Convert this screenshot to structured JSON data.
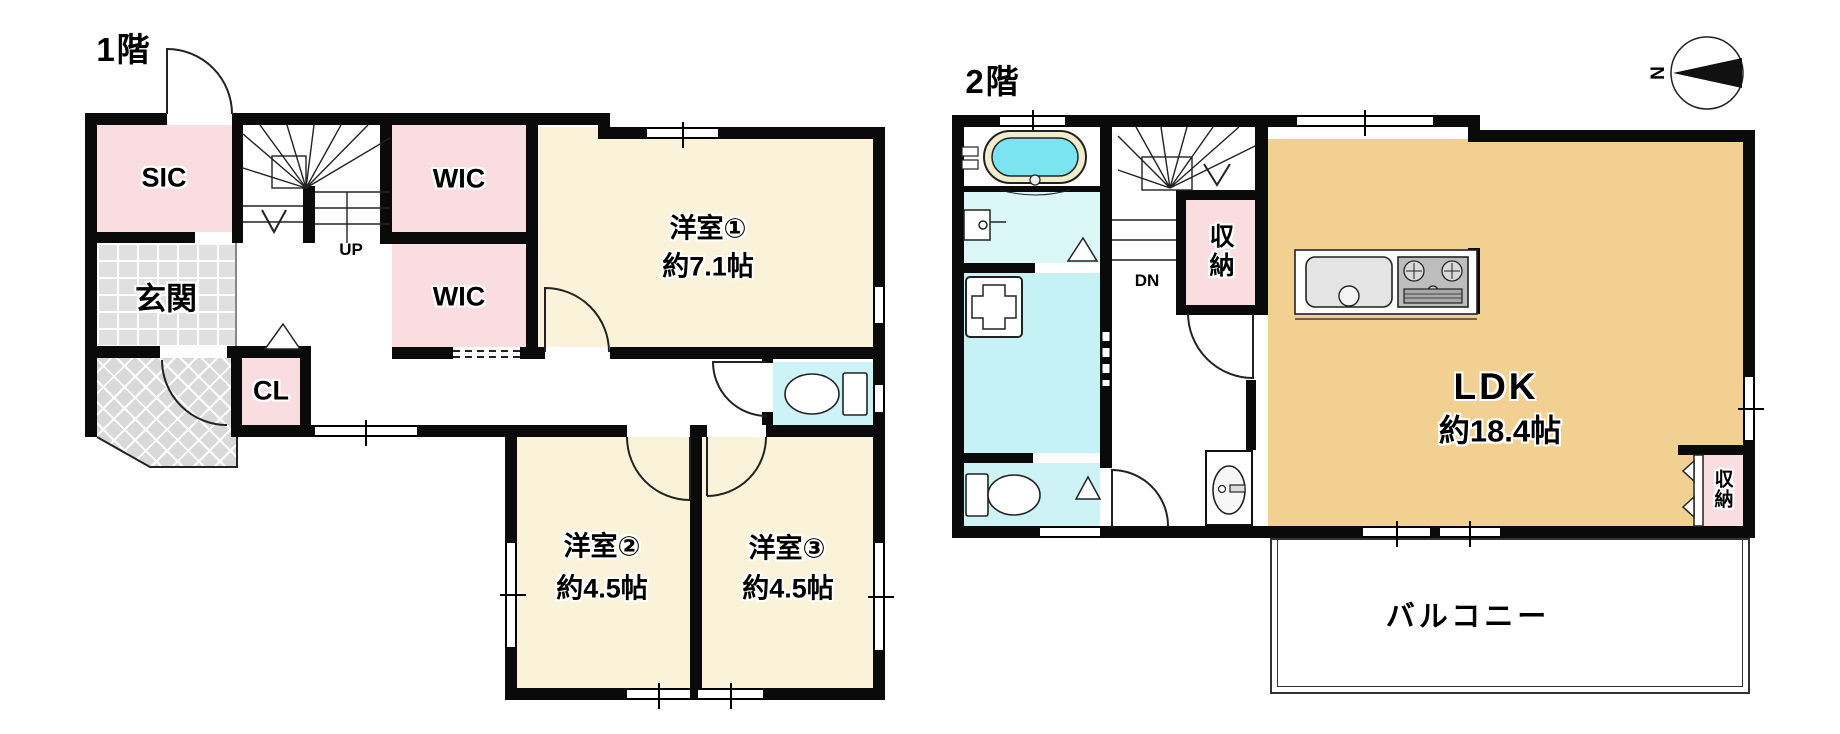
{
  "floor1": {
    "title": "1階",
    "stairs": {
      "label": "UP"
    },
    "rooms": {
      "sic": "SIC",
      "wic_upper": "WIC",
      "wic_lower": "WIC",
      "genkan": "玄関",
      "closet": "CL",
      "bedroom1_name": "洋室①",
      "bedroom1_size": "約7.1帖",
      "bedroom2_name": "洋室②",
      "bedroom2_size": "約4.5帖",
      "bedroom3_name": "洋室③",
      "bedroom3_size": "約4.5帖"
    }
  },
  "floor2": {
    "title": "2階",
    "stairs": {
      "label": "DN"
    },
    "rooms": {
      "storage_center": "収納",
      "storage_right": "収納",
      "ldk_name": "LDK",
      "ldk_size": "約18.4帖",
      "balcony": "バルコニー"
    }
  },
  "compass": {
    "north": "N"
  },
  "colors": {
    "wall": "#0a0a0a",
    "room_pink": "#fadde0",
    "room_cream": "#faf3d9",
    "room_tan": "#f2d092",
    "tile_gray": "#e0e0e0",
    "porch_gray": "#d9d9d9",
    "toilet_cyan": "#cdf3f7",
    "washroom_cyan": "#dbf7f8",
    "laundry_cyan": "#c7f2f5",
    "bathtub_cyan": "#7be4f0",
    "bathtub_ring": "#f2eccb"
  }
}
